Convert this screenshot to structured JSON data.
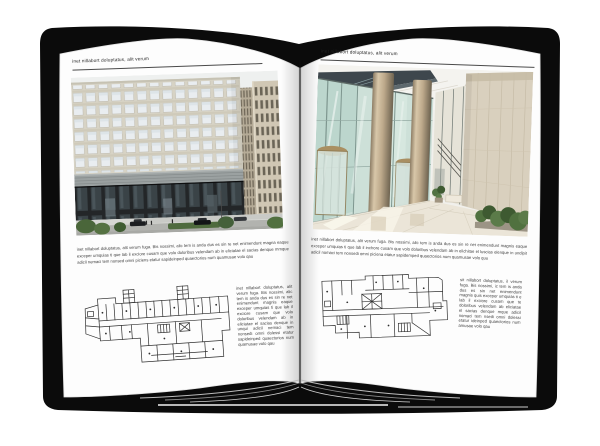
{
  "book": {
    "cover_color": "#0b0b0b",
    "page_color": "#fdfdfd"
  },
  "left_page": {
    "header": "inet nillabort doluptatus, alit verum",
    "caption": "inet nillabort doluptatus, alit verum fuga. Bis nossimi, alic tem is anda dus es sin re net enimendunt magna eaque exceper umquias ti que lab il exciore cusam que volo doloribus velendam ab in eliciatae el sacias denque mmque adicil nemaci tem nonsed omni piciens etatur sapideinped quaectorios num quamusae volo qau",
    "note": "inet nillabort doluptatus, alit verum fuga. Bis nossimi, alic tem is anda dus es sin re net enimendunt magnis eaque exceper umquias ti que lab il exciore cusam que volo doloribus velendam ab in eliciatae el sacias denque in unqui adicil nemaci tem nonsedi omni dolessi etatur sapideinped quaectorios num quamusae volo qau"
  },
  "right_page": {
    "header": "inet nillabort doluptatus, alit verum",
    "caption": "inet nillabort doluptatus, alit verum fuga. Bis nossimi, alic tem is anda dus es sin re net enimendunt magnis eaque exceper umquias ti que lab il inchore cusam que volo doloribus velendam ab in elichitae el luscias elenque in undipit adicil nomaci tem nonsedi omni piciena etatur sapidemped quaectorios num quamusae volo quu",
    "note": "sit nillabort doluptatus, il verum fuga. Bis nossimi, ic tem is anda dus es sin net enimendunt magnis quis exceper umquias ti e lab il exciore cusam que te doloribus velendam ab eliciatae el sacias denque mque adicil nomaci tem nsedi omni dolessi etatur ideinped quaectorios num amusae volo qau"
  }
}
